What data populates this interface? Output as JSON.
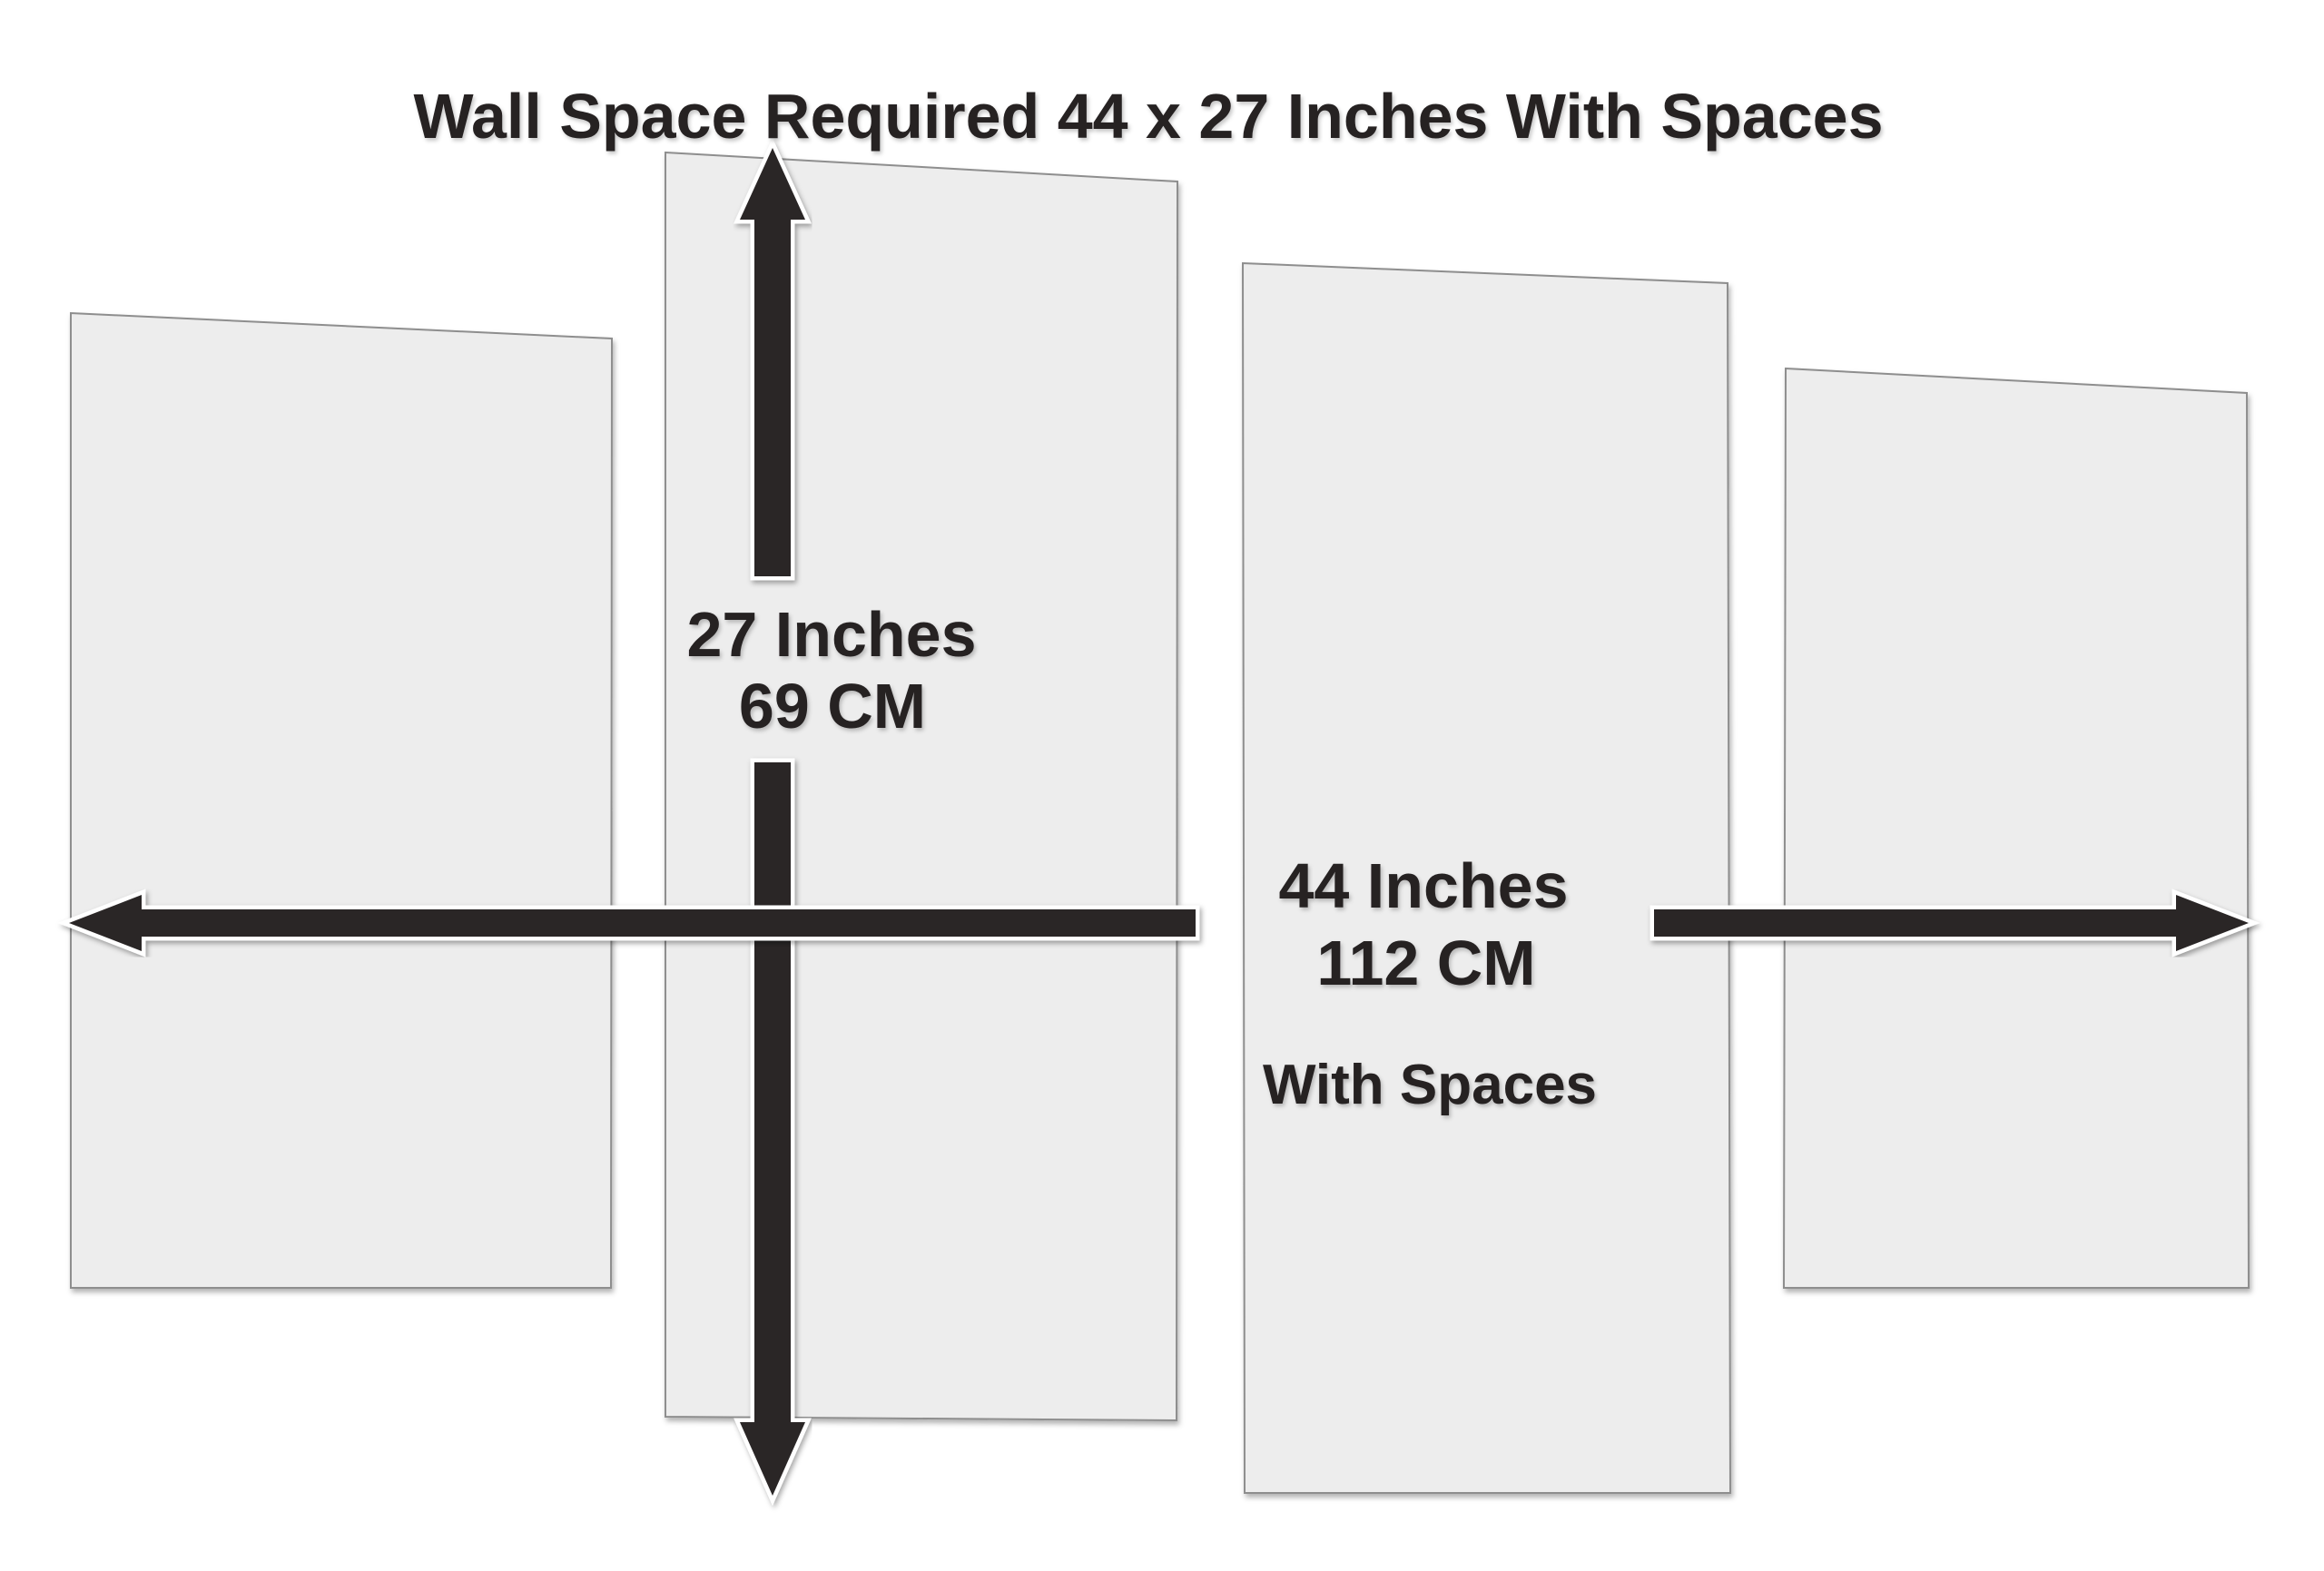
{
  "title": "Wall Space Required 44 x 27 Inches With Spaces",
  "vertical_dimension": {
    "inches": "27 Inches",
    "cm": "69 CM"
  },
  "horizontal_dimension": {
    "inches": "44 Inches",
    "cm": "112 CM",
    "note": "With Spaces"
  },
  "panels": {
    "count": "4"
  },
  "colors": {
    "background": "#ffffff",
    "panel_fill": "#ededed",
    "panel_border": "#8e8e8e",
    "arrow": "#2b2627",
    "text": "#252122"
  }
}
